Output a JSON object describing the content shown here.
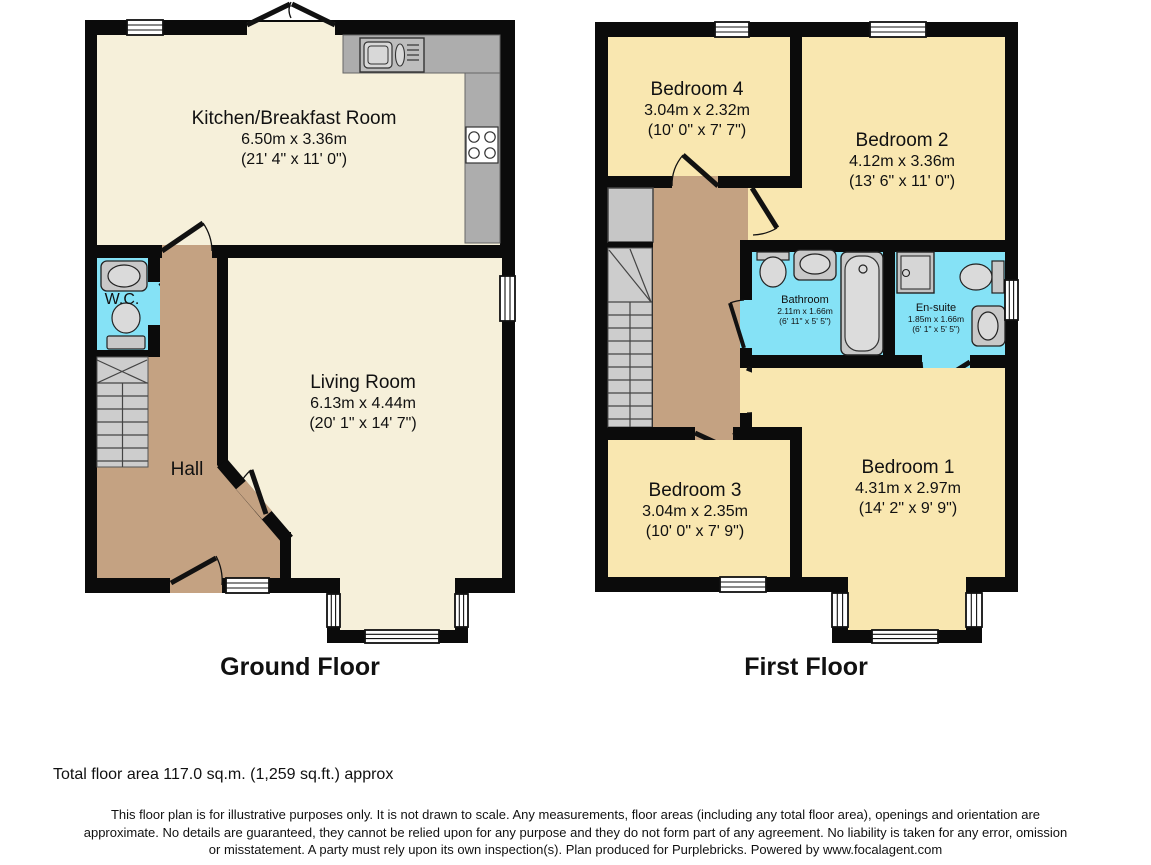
{
  "floors": [
    {
      "title": "Ground Floor",
      "rooms": {
        "kitchen": {
          "name": "Kitchen/Breakfast Room",
          "dims_m": "6.50m x 3.36m",
          "dims_ft": "(21' 4\" x 11' 0\")"
        },
        "living": {
          "name": "Living Room",
          "dims_m": "6.13m x 4.44m",
          "dims_ft": "(20' 1\" x 14' 7\")"
        },
        "wc": {
          "name": "W.C."
        },
        "hall": {
          "name": "Hall"
        }
      }
    },
    {
      "title": "First Floor",
      "rooms": {
        "bedroom4": {
          "name": "Bedroom 4",
          "dims_m": "3.04m x 2.32m",
          "dims_ft": "(10' 0\" x 7' 7\")"
        },
        "bedroom2": {
          "name": "Bedroom 2",
          "dims_m": "4.12m x 3.36m",
          "dims_ft": "(13' 6\" x 11' 0\")"
        },
        "bathroom": {
          "name": "Bathroom",
          "dims_m": "2.11m x 1.66m",
          "dims_ft": "(6' 11\" x 5' 5\")"
        },
        "ensuite": {
          "name": "En-suite",
          "dims_m": "1.85m x 1.66m",
          "dims_ft": "(6' 1\" x 5' 5\")"
        },
        "bedroom3": {
          "name": "Bedroom 3",
          "dims_m": "3.04m x 2.35m",
          "dims_ft": "(10' 0\" x 7' 9\")"
        },
        "bedroom1": {
          "name": "Bedroom 1",
          "dims_m": "4.31m x 2.97m",
          "dims_ft": "(14' 2\" x 9' 9\")"
        }
      }
    }
  ],
  "footer": {
    "total_area": "Total floor area 117.0 sq.m. (1,259 sq.ft.) approx",
    "disclaimer_lines": [
      "This floor plan is for illustrative purposes only. It is not drawn to scale. Any measurements, floor areas (including any total floor area), openings and orientation are",
      "approximate. No details are guaranteed, they cannot be relied upon for any purpose and they do not form part of any agreement. No liability is taken for any error, omission",
      "or misstatement. A party must rely upon its own inspection(s). Plan produced for Purplebricks. Powered by www.focalagent.com"
    ]
  },
  "colors": {
    "room_cream": "#F6F0DA",
    "room_yellow": "#F9E7B0",
    "hall_brown": "#C4A282",
    "wet_room_cyan": "#85E2F6",
    "wall_black": "#0B0B0B",
    "counter_gray": "#ADADAD",
    "stairs_gray": "#CDCDCD"
  }
}
